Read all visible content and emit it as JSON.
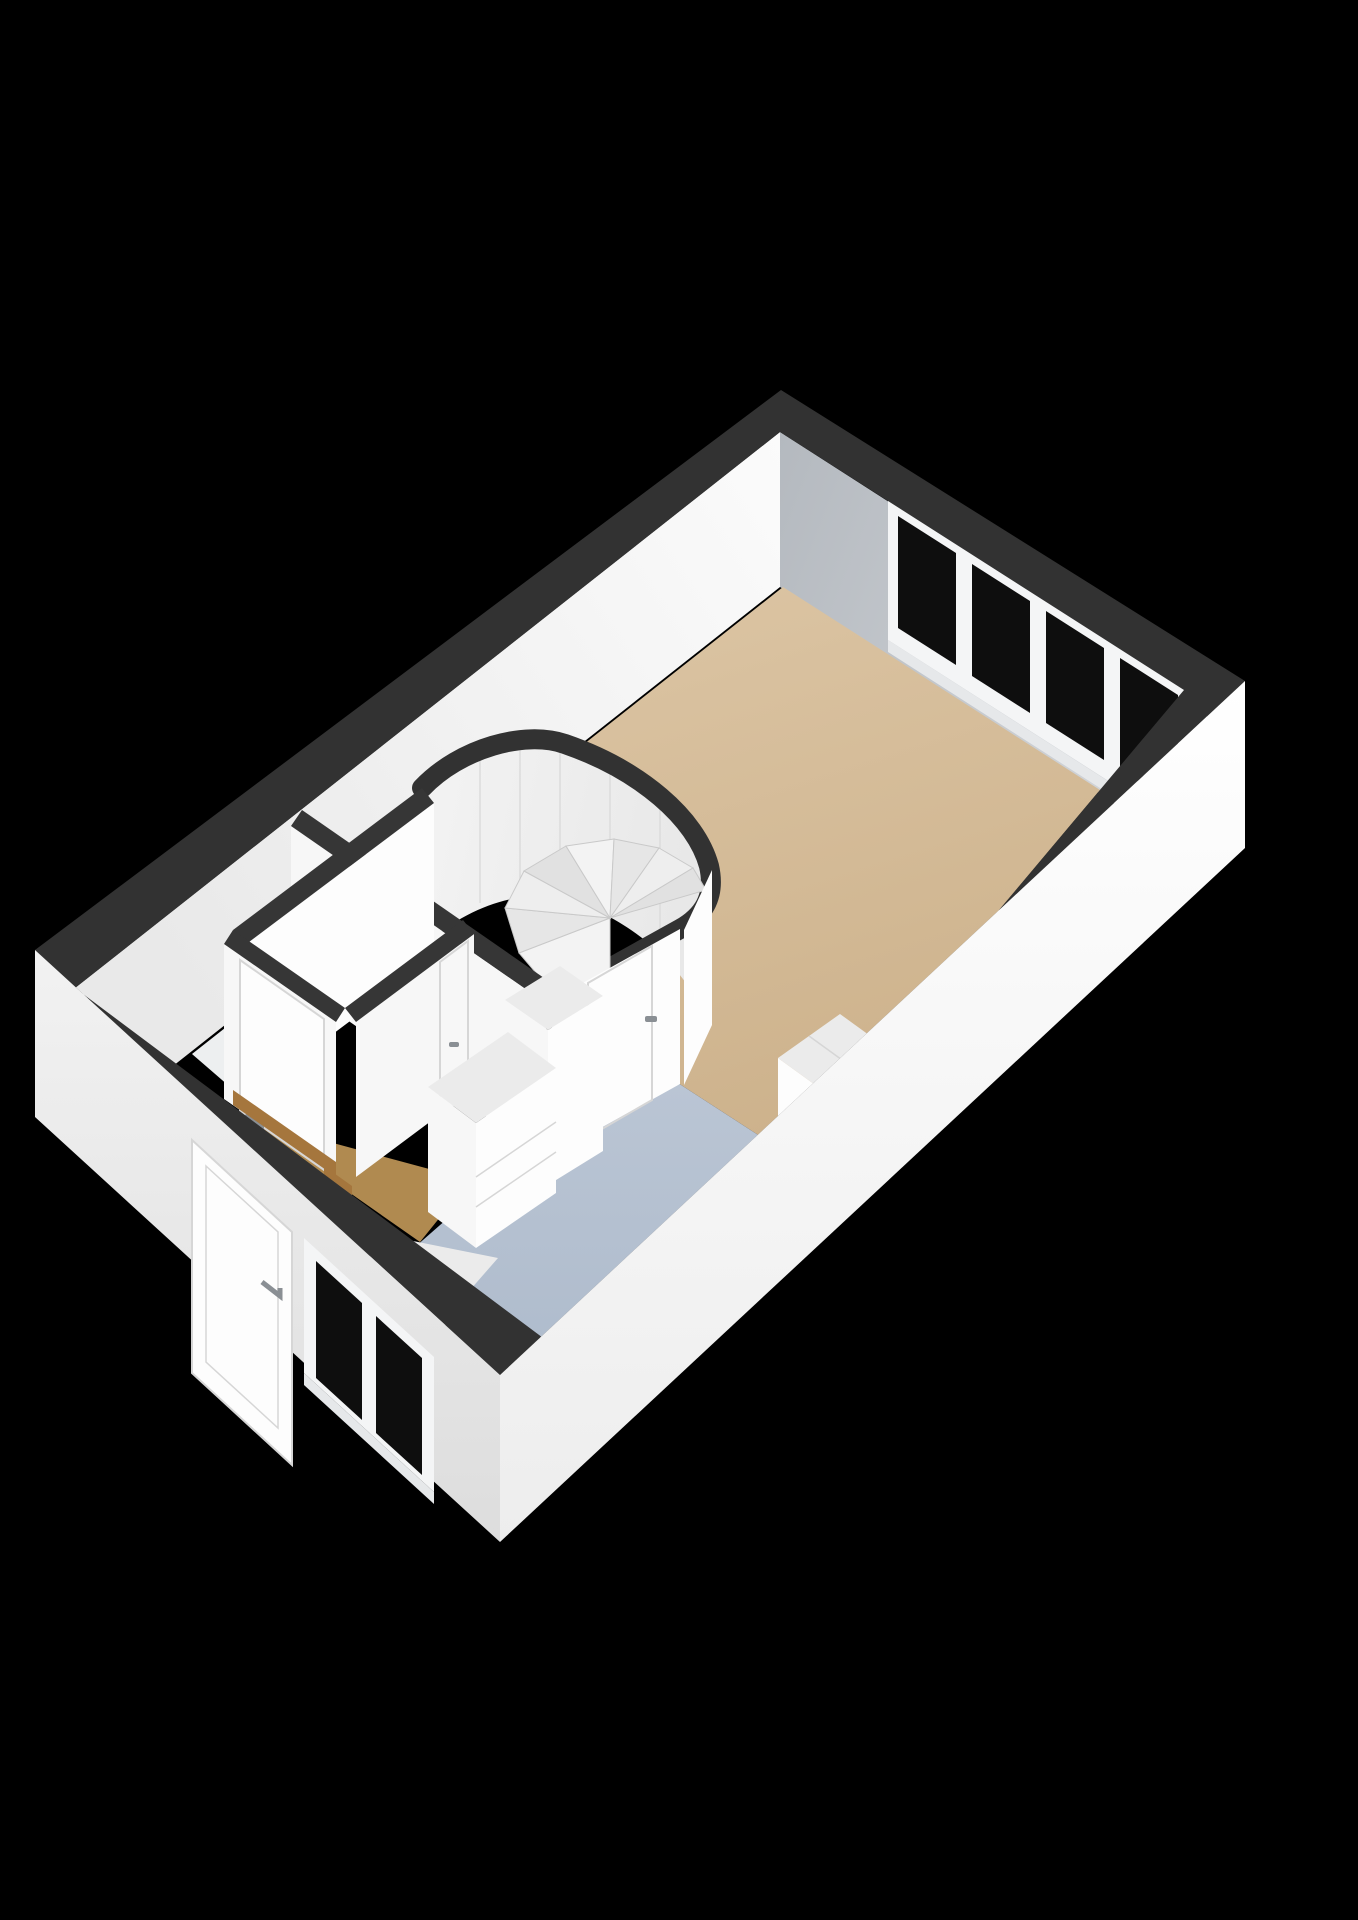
{
  "scene": {
    "kind": "3d-floorplan-render",
    "view": "isometric-from-south",
    "rooms": [
      "living-room",
      "stair-hall",
      "kitchen",
      "side-room",
      "sink-room",
      "entry-hall"
    ],
    "stairs": "spiral-staircase",
    "window_band_panes": 4,
    "exterior_window_panes": 2,
    "interior_doors": 4,
    "exterior_doors": 1
  },
  "colors": {
    "bg": "#000000",
    "band": "#323232",
    "band_inner": "#363636",
    "ne_wall_1": "#b4b9bf",
    "ne_wall_2": "#d2d5d9",
    "nw_wall_1": "#fbfbfb",
    "nw_wall_2": "#e9e9e9",
    "beige_1": "#dcc5a4",
    "beige_2": "#cdb28c",
    "blue_1": "#bac5d4",
    "blue_2": "#aebbcc",
    "wood": "#b08a50",
    "wood_dark": "#a5763d",
    "room_floor": "#edeff0",
    "glass": "#0e0e0e",
    "frame": "#f4f5f6",
    "sill": "#e6e8ea",
    "face_white": "#f7f7f7",
    "face_bright": "#fdfdfd",
    "face_dim": "#ededed",
    "inner_face_1": "#f3f3f3",
    "inner_face_2": "#e8e8e8",
    "seam": "#dcdcdc",
    "door_line": "#d6d6d6",
    "handle": "#8a8f94",
    "tread_a": "#f3f3f3",
    "tread_b": "#e6e6e6",
    "tread_c": "#eeeeee",
    "tread_d": "#e1e1e1",
    "tread_stroke": "#c9c9c9",
    "ext_se_1": "#ffffff",
    "ext_se_2": "#ededed",
    "ext_sw_1": "#f2f2f2",
    "ext_sw_2": "#dddddd",
    "cab_top": "#ebebeb",
    "tap_dark": "#3a3a3a",
    "tap_amber": "#8a6a30"
  }
}
